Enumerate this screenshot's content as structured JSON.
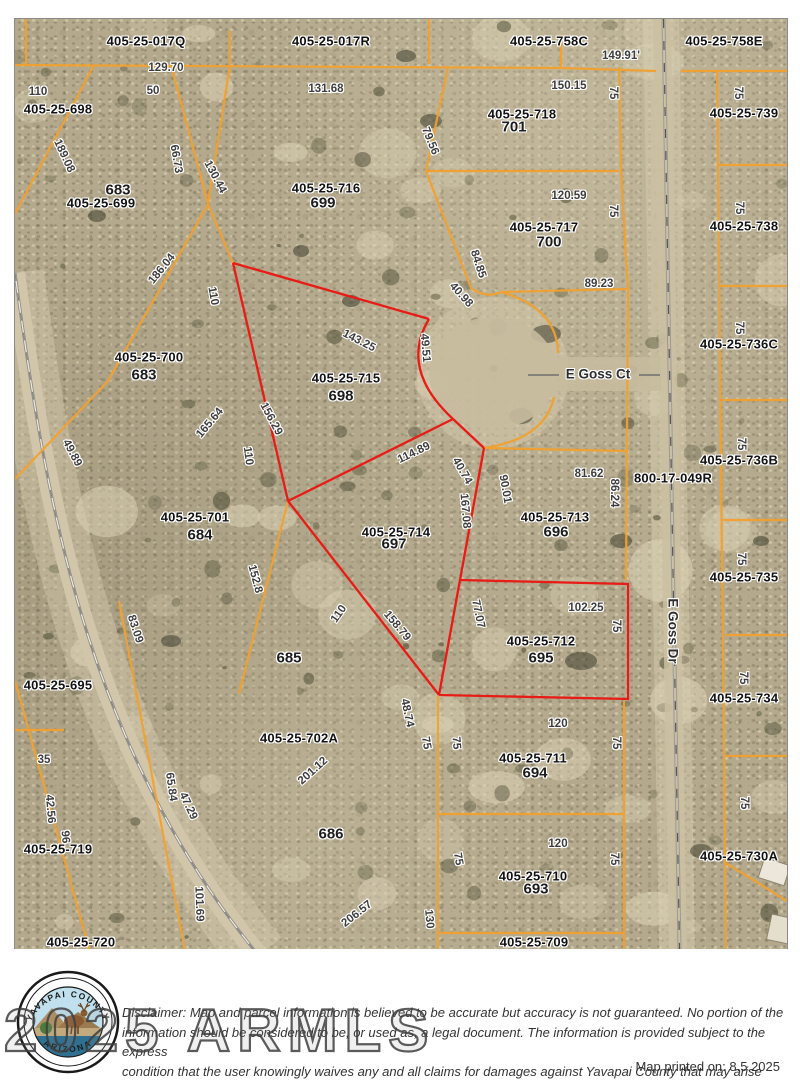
{
  "map": {
    "parcel_labels": [
      {
        "t": "405-25-017Q",
        "x": 145,
        "y": 40
      },
      {
        "t": "405-25-017R",
        "x": 330,
        "y": 40
      },
      {
        "t": "405-25-758C",
        "x": 548,
        "y": 40
      },
      {
        "t": "405-25-758E",
        "x": 723,
        "y": 40
      },
      {
        "t": "405-25-698",
        "x": 57,
        "y": 108
      },
      {
        "t": "405-25-699",
        "x": 100,
        "y": 202
      },
      {
        "t": "405-25-716",
        "x": 325,
        "y": 187
      },
      {
        "t": "405-25-718",
        "x": 521,
        "y": 113
      },
      {
        "t": "405-25-717",
        "x": 543,
        "y": 226
      },
      {
        "t": "405-25-739",
        "x": 743,
        "y": 112
      },
      {
        "t": "405-25-738",
        "x": 743,
        "y": 225
      },
      {
        "t": "405-25-700",
        "x": 148,
        "y": 356
      },
      {
        "t": "405-25-715",
        "x": 345,
        "y": 377
      },
      {
        "t": "405-25-736C",
        "x": 738,
        "y": 343
      },
      {
        "t": "405-25-701",
        "x": 194,
        "y": 516
      },
      {
        "t": "405-25-714",
        "x": 395,
        "y": 531
      },
      {
        "t": "405-25-713",
        "x": 554,
        "y": 516
      },
      {
        "t": "800-17-049R",
        "x": 672,
        "y": 477
      },
      {
        "t": "405-25-736B",
        "x": 738,
        "y": 459
      },
      {
        "t": "405-25-735",
        "x": 743,
        "y": 576
      },
      {
        "t": "405-25-712",
        "x": 540,
        "y": 640
      },
      {
        "t": "405-25-695",
        "x": 57,
        "y": 684
      },
      {
        "t": "405-25-734",
        "x": 743,
        "y": 697
      },
      {
        "t": "405-25-711",
        "x": 532,
        "y": 757
      },
      {
        "t": "405-25-702A",
        "x": 298,
        "y": 737
      },
      {
        "t": "405-25-710",
        "x": 532,
        "y": 875
      },
      {
        "t": "405-25-719",
        "x": 57,
        "y": 848
      },
      {
        "t": "405-25-730A",
        "x": 738,
        "y": 855
      },
      {
        "t": "405-25-709",
        "x": 533,
        "y": 941
      },
      {
        "t": "405-25-720",
        "x": 80,
        "y": 941
      }
    ],
    "parcel_numbers": [
      {
        "t": "683",
        "x": 117,
        "y": 189
      },
      {
        "t": "699",
        "x": 322,
        "y": 202
      },
      {
        "t": "701",
        "x": 513,
        "y": 126
      },
      {
        "t": "700",
        "x": 548,
        "y": 241
      },
      {
        "t": "683",
        "x": 143,
        "y": 374
      },
      {
        "t": "698",
        "x": 340,
        "y": 395
      },
      {
        "t": "684",
        "x": 199,
        "y": 534
      },
      {
        "t": "697",
        "x": 393,
        "y": 543
      },
      {
        "t": "696",
        "x": 555,
        "y": 531
      },
      {
        "t": "695",
        "x": 540,
        "y": 657
      },
      {
        "t": "685",
        "x": 288,
        "y": 657
      },
      {
        "t": "694",
        "x": 534,
        "y": 772
      },
      {
        "t": "686",
        "x": 330,
        "y": 833
      },
      {
        "t": "693",
        "x": 535,
        "y": 888
      }
    ],
    "dimensions": [
      {
        "t": "129.70",
        "x": 165,
        "y": 67,
        "r": 0
      },
      {
        "t": "110",
        "x": 37,
        "y": 91,
        "r": 0
      },
      {
        "t": "50",
        "x": 152,
        "y": 90,
        "r": 0
      },
      {
        "t": "131.68",
        "x": 325,
        "y": 88,
        "r": 0
      },
      {
        "t": "149.91'",
        "x": 620,
        "y": 55,
        "r": 0
      },
      {
        "t": "150.15",
        "x": 568,
        "y": 85,
        "r": 0
      },
      {
        "t": "75",
        "x": 612,
        "y": 92,
        "r": 90
      },
      {
        "t": "75",
        "x": 737,
        "y": 92,
        "r": 90
      },
      {
        "t": "189.08",
        "x": 63,
        "y": 155,
        "r": 65
      },
      {
        "t": "66.73",
        "x": 175,
        "y": 158,
        "r": 80
      },
      {
        "t": "130.44",
        "x": 214,
        "y": 176,
        "r": 62
      },
      {
        "t": "79.56",
        "x": 429,
        "y": 140,
        "r": 68
      },
      {
        "t": "120.59",
        "x": 568,
        "y": 195,
        "r": 0
      },
      {
        "t": "75",
        "x": 612,
        "y": 210,
        "r": 90
      },
      {
        "t": "75",
        "x": 738,
        "y": 207,
        "r": 90
      },
      {
        "t": "186.04",
        "x": 161,
        "y": 268,
        "r": -51
      },
      {
        "t": "110",
        "x": 212,
        "y": 295,
        "r": 80
      },
      {
        "t": "84.85",
        "x": 477,
        "y": 263,
        "r": 72
      },
      {
        "t": "40.98",
        "x": 460,
        "y": 294,
        "r": 48
      },
      {
        "t": "89.23",
        "x": 598,
        "y": 283,
        "r": 0
      },
      {
        "t": "143.25",
        "x": 358,
        "y": 340,
        "r": 27
      },
      {
        "t": "49.51",
        "x": 424,
        "y": 347,
        "r": 85
      },
      {
        "t": "156.29",
        "x": 270,
        "y": 418,
        "r": 62
      },
      {
        "t": "165.64",
        "x": 209,
        "y": 422,
        "r": -50
      },
      {
        "t": "110",
        "x": 247,
        "y": 455,
        "r": 82
      },
      {
        "t": "49.89",
        "x": 71,
        "y": 452,
        "r": 62
      },
      {
        "t": "114.89",
        "x": 413,
        "y": 452,
        "r": -26
      },
      {
        "t": "40.74",
        "x": 461,
        "y": 470,
        "r": 60
      },
      {
        "t": "167.08",
        "x": 464,
        "y": 510,
        "r": 85
      },
      {
        "t": "90.01",
        "x": 504,
        "y": 488,
        "r": 80
      },
      {
        "t": "81.62",
        "x": 588,
        "y": 473,
        "r": 0
      },
      {
        "t": "86.24",
        "x": 613,
        "y": 492,
        "r": 90
      },
      {
        "t": "75",
        "x": 738,
        "y": 327,
        "r": 90
      },
      {
        "t": "75",
        "x": 740,
        "y": 443,
        "r": 90
      },
      {
        "t": "75",
        "x": 740,
        "y": 558,
        "r": 90
      },
      {
        "t": "152.8",
        "x": 254,
        "y": 578,
        "r": 75
      },
      {
        "t": "110",
        "x": 338,
        "y": 613,
        "r": -55
      },
      {
        "t": "158.79",
        "x": 396,
        "y": 625,
        "r": 50
      },
      {
        "t": "83.09",
        "x": 134,
        "y": 628,
        "r": 72
      },
      {
        "t": "102.25",
        "x": 585,
        "y": 607,
        "r": 0
      },
      {
        "t": "77.07",
        "x": 477,
        "y": 613,
        "r": 78
      },
      {
        "t": "75",
        "x": 615,
        "y": 625,
        "r": 90
      },
      {
        "t": "120",
        "x": 557,
        "y": 723,
        "r": 0
      },
      {
        "t": "48.74",
        "x": 406,
        "y": 712,
        "r": 78
      },
      {
        "t": "75",
        "x": 425,
        "y": 742,
        "r": 80
      },
      {
        "t": "75",
        "x": 455,
        "y": 742,
        "r": 85
      },
      {
        "t": "75",
        "x": 615,
        "y": 742,
        "r": 90
      },
      {
        "t": "75",
        "x": 742,
        "y": 677,
        "r": 90
      },
      {
        "t": "201.12",
        "x": 312,
        "y": 770,
        "r": -42
      },
      {
        "t": "35",
        "x": 43,
        "y": 759,
        "r": 0
      },
      {
        "t": "42.56",
        "x": 49,
        "y": 808,
        "r": 85
      },
      {
        "t": "96",
        "x": 64,
        "y": 836,
        "r": 85
      },
      {
        "t": "65.84",
        "x": 170,
        "y": 786,
        "r": 82
      },
      {
        "t": "47.29",
        "x": 187,
        "y": 805,
        "r": 65
      },
      {
        "t": "75",
        "x": 743,
        "y": 802,
        "r": 90
      },
      {
        "t": "120",
        "x": 557,
        "y": 843,
        "r": 0
      },
      {
        "t": "75",
        "x": 457,
        "y": 858,
        "r": 80
      },
      {
        "t": "75",
        "x": 613,
        "y": 858,
        "r": 90
      },
      {
        "t": "101.69",
        "x": 198,
        "y": 903,
        "r": 88
      },
      {
        "t": "206.57",
        "x": 356,
        "y": 913,
        "r": -38
      },
      {
        "t": "130",
        "x": 428,
        "y": 918,
        "r": 85
      }
    ],
    "streets": [
      {
        "t": "E Goss Ct",
        "x": 597,
        "y": 373,
        "r": 0
      },
      {
        "t": "E Goss Dr",
        "x": 672,
        "y": 630,
        "r": 90
      }
    ]
  },
  "colors": {
    "parcel_line": "#f2a12e",
    "highlight_line": "#e81c16"
  },
  "footer": {
    "watermark": "2025 ARMLS",
    "disclaimer_lines": [
      "Disclaimer: Map and parcel information is believed to be accurate but accuracy is not guaranteed. No portion of the",
      "information should be considered to be, or used as, a legal document.  The information is provided subject to the express",
      "condition that the user knowingly waives any and all claims for damages against Yavapai County that may arise from the",
      "use of this data."
    ],
    "printed": "Map printed on: 8.5.2025",
    "seal_top": "YAVAPAI COUNTY",
    "seal_bottom": "ARIZONA"
  }
}
